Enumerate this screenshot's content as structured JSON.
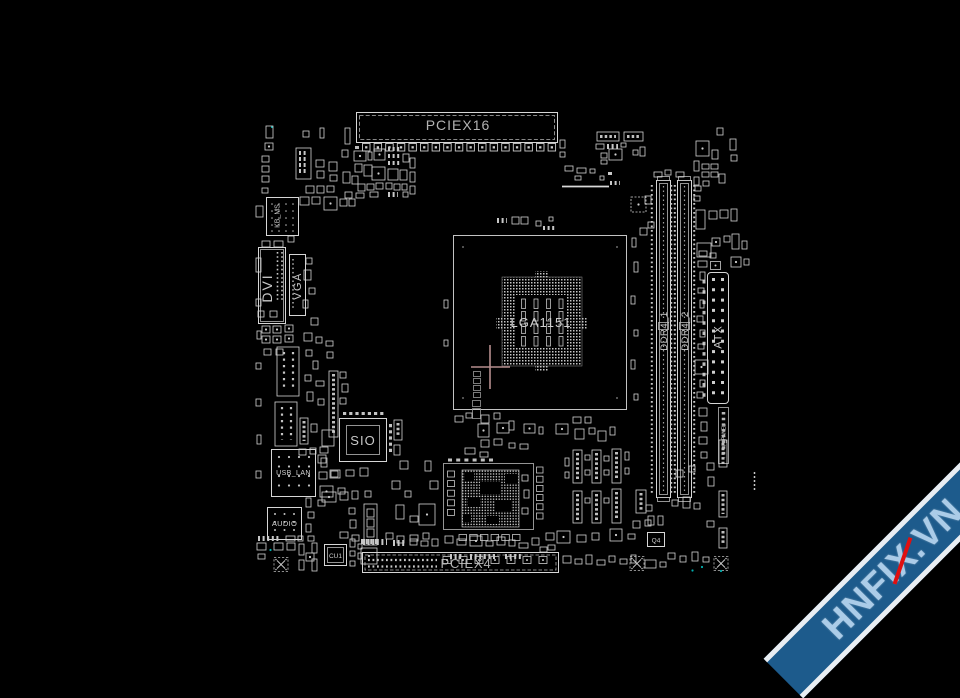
{
  "board": {
    "slots": {
      "pciex16": "PCIEX16",
      "pciex4": "PCIEX4",
      "ddr4_1": "DDR4_1",
      "ddr4_2": "DDR4_2",
      "atx": "ATX",
      "f_panel": "F_PANEL"
    },
    "cpu_socket": "LGA1151",
    "chips": {
      "sio": "SIO",
      "cu1": "CU1",
      "q4": "Q4"
    },
    "io": {
      "kb_ms": "KB_MS",
      "dvi": "DVI",
      "vga": "VGA",
      "usb_lan": "USB_LAN",
      "audio": "AUDIO"
    }
  },
  "watermark": {
    "prefix": "HNFI",
    "x_char": "X",
    "suffix": ".VN"
  },
  "colors": {
    "background": "#000000",
    "line": "#d6d6d6",
    "label": "#b2b2b2",
    "crosshair": "#b68e8e",
    "teal_dot": "#00afaf",
    "ribbon": "#1d5b8c",
    "ribbon_text": "#abcce8",
    "ribbon_accent": "#e01010"
  }
}
